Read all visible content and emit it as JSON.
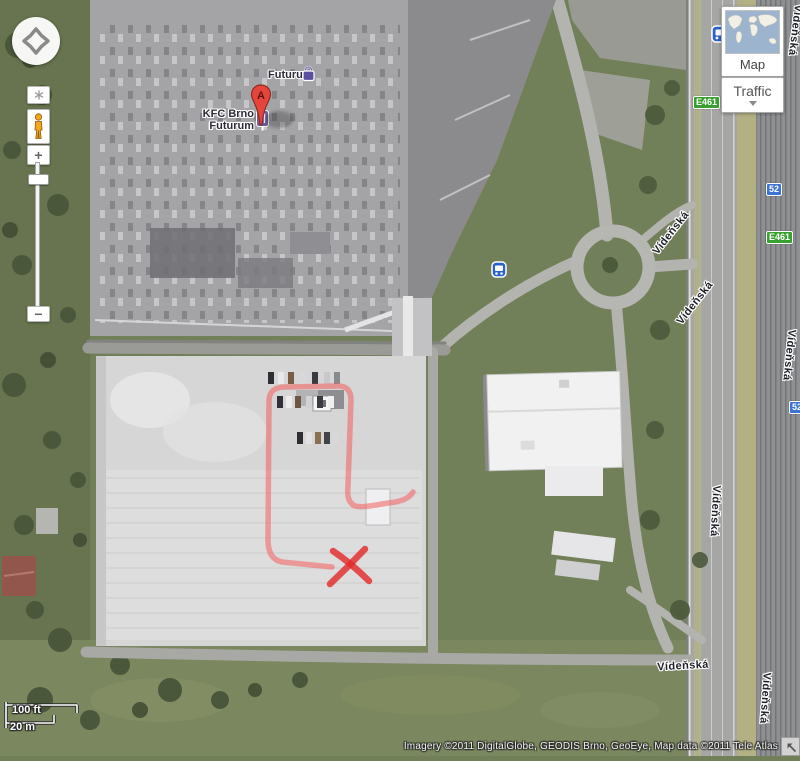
{
  "map_controls": {
    "zoom_in": "+",
    "zoom_out": "−"
  },
  "layers_panel": {
    "map_button": "Map",
    "traffic_button": "Traffic"
  },
  "marker": {
    "label": "A"
  },
  "pois": [
    {
      "name": "Futurum",
      "icon": "shopping-bag"
    },
    {
      "name_line1": "KFC Brno",
      "name_line2": "Futurum",
      "icon": "restaurant"
    }
  ],
  "street_labels": [
    {
      "text": "Vídeňská"
    },
    {
      "text": "Vídeňská"
    },
    {
      "text": "Vídeňská"
    },
    {
      "text": "Vídeňská"
    },
    {
      "text": "Vídeňská"
    },
    {
      "text": "Vídeňská"
    },
    {
      "text": "Vídeňská"
    }
  ],
  "route_badges": [
    {
      "text": "E461",
      "type": "green"
    },
    {
      "text": "52",
      "type": "blue"
    },
    {
      "text": "E461",
      "type": "green"
    },
    {
      "text": "52",
      "type": "blue"
    }
  ],
  "scale_bar": {
    "imperial": "100 ft",
    "metric": "20 m"
  },
  "attribution": {
    "text": "Imagery ©2011 DigitalGlobe, GEODIS Brno, GeoEye, Map data ©2011 Tele Atlas"
  },
  "annotation": {
    "description": "hand-drawn red route loop through parking lot ending at an X mark",
    "color": "#ef5350"
  },
  "colors": {
    "marker_red": "#e5453c",
    "badge_blue": "#3c74d6",
    "badge_green": "#38a02e",
    "pegman_orange": "#f6a71e",
    "annotation_red": "#ef5350"
  }
}
